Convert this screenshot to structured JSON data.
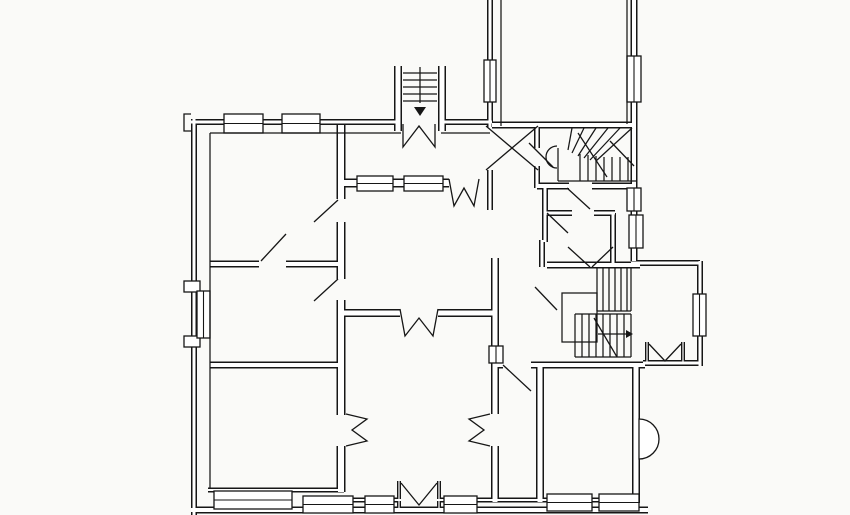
{
  "meta": {
    "background": "#fafaf8",
    "ink": "#161616",
    "core": "#ffffff",
    "canvas_width": 850,
    "canvas_height": 515
  },
  "plan": {
    "double_walls": [
      {
        "t": 6,
        "pts": [
          [
            194,
            119
          ],
          [
            194,
            515
          ]
        ]
      },
      {
        "t": 6,
        "pts": [
          [
            191,
            122
          ],
          [
            399,
            122
          ]
        ]
      },
      {
        "t": 6,
        "pts": [
          [
            441,
            122
          ],
          [
            492,
            122
          ]
        ]
      },
      {
        "t": 6,
        "pts": [
          [
            490,
            0
          ],
          [
            490,
            127
          ]
        ]
      },
      {
        "t": 7,
        "pts": [
          [
            634,
            0
          ],
          [
            634,
            261
          ]
        ]
      },
      {
        "t": 6,
        "pts": [
          [
            631,
            263
          ],
          [
            700,
            263
          ]
        ]
      },
      {
        "t": 6,
        "pts": [
          [
            700,
            261
          ],
          [
            700,
            366
          ]
        ]
      },
      {
        "t": 6,
        "pts": [
          [
            700,
            363
          ],
          [
            643,
            363
          ]
        ]
      },
      {
        "t": 8,
        "pts": [
          [
            636,
            363
          ],
          [
            636,
            503
          ]
        ]
      },
      {
        "t": 7,
        "pts": [
          [
            191,
            510
          ],
          [
            648,
            510
          ]
        ]
      },
      {
        "t": 7,
        "pts": [
          [
            492,
            125
          ],
          [
            634,
            125
          ]
        ]
      },
      {
        "t": 9,
        "pts": [
          [
            341,
            125
          ],
          [
            341,
            199
          ]
        ]
      },
      {
        "t": 9,
        "pts": [
          [
            341,
            222
          ],
          [
            341,
            279
          ]
        ]
      },
      {
        "t": 9,
        "pts": [
          [
            341,
            300
          ],
          [
            341,
            415
          ]
        ]
      },
      {
        "t": 9,
        "pts": [
          [
            341,
            446
          ],
          [
            341,
            492
          ]
        ]
      },
      {
        "t": 7,
        "pts": [
          [
            210,
            264
          ],
          [
            259,
            264
          ]
        ]
      },
      {
        "t": 7,
        "pts": [
          [
            286,
            264
          ],
          [
            344,
            264
          ]
        ]
      },
      {
        "t": 7,
        "pts": [
          [
            210,
            365
          ],
          [
            344,
            365
          ]
        ]
      },
      {
        "t": 9,
        "pts": [
          [
            343,
            183
          ],
          [
            449,
            183
          ]
        ]
      },
      {
        "t": 8,
        "pts": [
          [
            341,
            313
          ],
          [
            400,
            313
          ]
        ]
      },
      {
        "t": 8,
        "pts": [
          [
            438,
            313
          ],
          [
            497,
            313
          ]
        ]
      },
      {
        "t": 8,
        "pts": [
          [
            495,
            258
          ],
          [
            495,
            414
          ]
        ]
      },
      {
        "t": 8,
        "pts": [
          [
            495,
            446
          ],
          [
            495,
            502
          ]
        ]
      },
      {
        "t": 8,
        "pts": [
          [
            540,
            364
          ],
          [
            540,
            502
          ]
        ]
      },
      {
        "t": 7,
        "pts": [
          [
            547,
            265
          ],
          [
            640,
            265
          ]
        ]
      },
      {
        "t": 7,
        "pts": [
          [
            537,
            186
          ],
          [
            569,
            186
          ]
        ]
      },
      {
        "t": 7,
        "pts": [
          [
            592,
            186
          ],
          [
            636,
            186
          ]
        ]
      },
      {
        "t": 6,
        "pts": [
          [
            537,
            125
          ],
          [
            537,
            148
          ]
        ]
      },
      {
        "t": 6,
        "pts": [
          [
            537,
            166
          ],
          [
            537,
            188
          ]
        ]
      },
      {
        "t": 6,
        "pts": [
          [
            490,
            170
          ],
          [
            490,
            210
          ]
        ]
      },
      {
        "t": 6,
        "pts": [
          [
            545,
            213
          ],
          [
            572,
            213
          ]
        ]
      },
      {
        "t": 6,
        "pts": [
          [
            594,
            213
          ],
          [
            615,
            213
          ]
        ]
      },
      {
        "t": 6,
        "pts": [
          [
            613,
            213
          ],
          [
            613,
            263
          ]
        ]
      },
      {
        "t": 6,
        "pts": [
          [
            545,
            186
          ],
          [
            545,
            242
          ]
        ]
      },
      {
        "t": 6,
        "pts": [
          [
            542,
            240
          ],
          [
            542,
            267
          ]
        ]
      },
      {
        "t": 7,
        "pts": [
          [
            495,
            365
          ],
          [
            503,
            365
          ]
        ]
      },
      {
        "t": 7,
        "pts": [
          [
            531,
            365
          ],
          [
            645,
            365
          ]
        ]
      },
      {
        "t": 5,
        "pts": [
          [
            208,
            490
          ],
          [
            344,
            490
          ]
        ]
      },
      {
        "t": 5,
        "pts": [
          [
            341,
            500
          ],
          [
            401,
            500
          ]
        ]
      },
      {
        "t": 5,
        "pts": [
          [
            437,
            500
          ],
          [
            542,
            500
          ]
        ]
      },
      {
        "t": 5,
        "pts": [
          [
            538,
            500
          ],
          [
            638,
            500
          ]
        ]
      },
      {
        "t": 4,
        "pts": [
          [
            399,
            481
          ],
          [
            399,
            509
          ]
        ]
      },
      {
        "t": 4,
        "pts": [
          [
            439,
            481
          ],
          [
            439,
            509
          ]
        ]
      },
      {
        "t": 4,
        "pts": [
          [
            647,
            342
          ],
          [
            647,
            363
          ]
        ]
      },
      {
        "t": 4,
        "pts": [
          [
            683,
            342
          ],
          [
            683,
            363
          ]
        ]
      },
      {
        "t": 8,
        "pts": [
          [
            398,
            66
          ],
          [
            398,
            131
          ]
        ]
      },
      {
        "t": 8,
        "pts": [
          [
            442,
            66
          ],
          [
            442,
            131
          ]
        ]
      }
    ],
    "inner_lines": [
      [
        210,
        133,
        210,
        489
      ],
      [
        210,
        133,
        401,
        133
      ],
      [
        441,
        133,
        490,
        133
      ],
      [
        501,
        0,
        501,
        126
      ],
      [
        627,
        0,
        627,
        124
      ],
      [
        558,
        181,
        636,
        181
      ],
      [
        558,
        148,
        558,
        181
      ],
      [
        403,
        73,
        437,
        73
      ],
      [
        403,
        80,
        437,
        80
      ],
      [
        403,
        87,
        437,
        87
      ],
      [
        403,
        94,
        437,
        94
      ],
      [
        403,
        101,
        437,
        101
      ],
      [
        420,
        67,
        420,
        103
      ],
      [
        568,
        150,
        572,
        128
      ],
      [
        572,
        153,
        584,
        128
      ],
      [
        578,
        156,
        596,
        128
      ],
      [
        584,
        158,
        608,
        128
      ],
      [
        590,
        160,
        620,
        128
      ],
      [
        596,
        161,
        632,
        128
      ],
      [
        580,
        154,
        580,
        181
      ],
      [
        588,
        155,
        588,
        181
      ],
      [
        596,
        156,
        596,
        181
      ],
      [
        604,
        157,
        604,
        181
      ],
      [
        612,
        157,
        612,
        181
      ],
      [
        620,
        157,
        620,
        181
      ],
      [
        628,
        157,
        628,
        181
      ],
      [
        578,
        133,
        607,
        177
      ],
      [
        597,
        268,
        597,
        311
      ],
      [
        631,
        268,
        631,
        311
      ],
      [
        597,
        311,
        631,
        311
      ],
      [
        603,
        268,
        603,
        311
      ],
      [
        609,
        268,
        609,
        311
      ],
      [
        615,
        268,
        615,
        311
      ],
      [
        621,
        268,
        621,
        311
      ],
      [
        627,
        268,
        627,
        311
      ],
      [
        575,
        314,
        631,
        314
      ],
      [
        575,
        314,
        575,
        357
      ],
      [
        575,
        357,
        631,
        357
      ],
      [
        631,
        314,
        631,
        357
      ],
      [
        582,
        314,
        582,
        357
      ],
      [
        589,
        314,
        589,
        357
      ],
      [
        596,
        314,
        596,
        357
      ],
      [
        603,
        314,
        603,
        357
      ],
      [
        610,
        314,
        610,
        357
      ],
      [
        617,
        314,
        617,
        357
      ],
      [
        624,
        314,
        624,
        357
      ],
      [
        594,
        318,
        617,
        357
      ],
      [
        598,
        334,
        626,
        334
      ]
    ],
    "windows": [
      {
        "x": 224,
        "y": 114,
        "w": 39,
        "h": 19,
        "o": "h"
      },
      {
        "x": 282,
        "y": 114,
        "w": 38,
        "h": 19,
        "o": "h"
      },
      {
        "x": 357,
        "y": 176,
        "w": 36,
        "h": 15,
        "o": "h"
      },
      {
        "x": 404,
        "y": 176,
        "w": 39,
        "h": 15,
        "o": "h"
      },
      {
        "x": 484,
        "y": 60,
        "w": 12,
        "h": 42,
        "o": "v"
      },
      {
        "x": 627,
        "y": 56,
        "w": 14,
        "h": 46,
        "o": "v"
      },
      {
        "x": 627,
        "y": 188,
        "w": 14,
        "h": 23,
        "o": "v"
      },
      {
        "x": 629,
        "y": 215,
        "w": 14,
        "h": 33,
        "o": "v"
      },
      {
        "x": 693,
        "y": 294,
        "w": 13,
        "h": 42,
        "o": "v"
      },
      {
        "x": 197,
        "y": 291,
        "w": 13,
        "h": 47,
        "o": "v"
      },
      {
        "x": 489,
        "y": 346,
        "w": 14,
        "h": 17,
        "o": "v"
      },
      {
        "x": 214,
        "y": 491,
        "w": 78,
        "h": 18,
        "o": "h"
      },
      {
        "x": 303,
        "y": 496,
        "w": 50,
        "h": 17,
        "o": "h"
      },
      {
        "x": 365,
        "y": 496,
        "w": 29,
        "h": 17,
        "o": "h"
      },
      {
        "x": 444,
        "y": 496,
        "w": 33,
        "h": 17,
        "o": "h"
      },
      {
        "x": 547,
        "y": 494,
        "w": 45,
        "h": 17,
        "o": "h"
      },
      {
        "x": 599,
        "y": 494,
        "w": 40,
        "h": 17,
        "o": "h"
      }
    ],
    "solid_rects": [
      [
        184,
        281,
        16,
        11
      ],
      [
        184,
        336,
        16,
        11
      ]
    ],
    "outline_rects": [
      [
        562,
        293,
        35,
        49
      ]
    ],
    "zigzags": [
      [
        [
          449,
          179
        ],
        [
          454,
          206
        ],
        [
          464,
          188
        ],
        [
          474,
          206
        ],
        [
          479,
          179
        ]
      ],
      [
        [
          400,
          309
        ],
        [
          405,
          336
        ],
        [
          419,
          318
        ],
        [
          433,
          336
        ],
        [
          438,
          309
        ]
      ],
      [
        [
          346,
          414
        ],
        [
          367,
          419
        ],
        [
          352,
          430
        ],
        [
          367,
          441
        ],
        [
          346,
          446
        ]
      ],
      [
        [
          490,
          414
        ],
        [
          469,
          419
        ],
        [
          484,
          430
        ],
        [
          469,
          441
        ],
        [
          490,
          446
        ]
      ],
      [
        [
          403,
          124
        ],
        [
          403,
          147
        ],
        [
          419,
          126
        ],
        [
          435,
          147
        ],
        [
          435,
          124
        ]
      ],
      [
        [
          401,
          483
        ],
        [
          419,
          505
        ],
        [
          437,
          483
        ]
      ],
      [
        [
          649,
          344
        ],
        [
          665,
          361
        ],
        [
          681,
          344
        ]
      ],
      [
        [
          191,
          131
        ],
        [
          184,
          131
        ],
        [
          184,
          114
        ],
        [
          191,
          114
        ]
      ]
    ],
    "door_leaves": [
      [
        261,
        261,
        286,
        234
      ],
      [
        314,
        222,
        338,
        200
      ],
      [
        314,
        301,
        338,
        279
      ],
      [
        486,
        126,
        538,
        170
      ],
      [
        486,
        170,
        538,
        126
      ],
      [
        610,
        141,
        634,
        166
      ],
      [
        529,
        143,
        553,
        167
      ],
      [
        567,
        188,
        590,
        209
      ],
      [
        547,
        213,
        568,
        233
      ],
      [
        568,
        247,
        590,
        267
      ],
      [
        592,
        267,
        613,
        247
      ],
      [
        535,
        287,
        557,
        310
      ],
      [
        503,
        365,
        531,
        391
      ]
    ],
    "paths": [
      {
        "d": "M 639 419 A 20 20 0 0 1 639 459 Z",
        "fill": "#ffffff"
      },
      {
        "d": "M 557 146 A 10 10 0 0 0 557 168",
        "fill": "none"
      }
    ],
    "arrows": [
      [
        [
          414,
          107
        ],
        [
          426,
          107
        ],
        [
          420,
          116
        ]
      ],
      [
        [
          626,
          330
        ],
        [
          626,
          338
        ],
        [
          633,
          334
        ]
      ]
    ]
  }
}
